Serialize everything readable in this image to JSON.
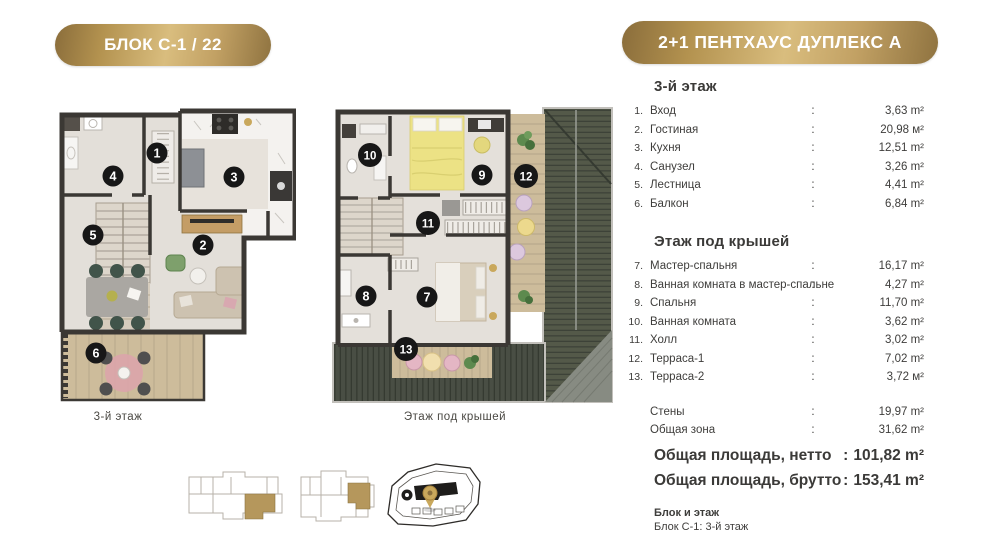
{
  "header": {
    "block_badge": "БЛОК С-1 / 22",
    "unit_badge": "2+1 ПЕНТХАУС ДУПЛЕКС А"
  },
  "punct": {
    "colon": ":"
  },
  "floor3": {
    "title": "3-й этаж",
    "plan_caption": "3-й  этаж",
    "items": [
      {
        "num": "1.",
        "label": "Вход",
        "value": "3,63 m²"
      },
      {
        "num": "2.",
        "label": "Гостиная",
        "value": "20,98 м²"
      },
      {
        "num": "3.",
        "label": "Кухня",
        "value": "12,51 m²"
      },
      {
        "num": "4.",
        "label": "Санузел",
        "value": "3,26 m²"
      },
      {
        "num": "5.",
        "label": "Лестница",
        "value": "4,41 m²"
      },
      {
        "num": "6.",
        "label": "Балкон",
        "value": "6,84 m²"
      }
    ]
  },
  "attic": {
    "title": "Этаж под крышей",
    "plan_caption": "Этаж под крышей",
    "items": [
      {
        "num": "7.",
        "label": "Мастер-спальня",
        "value": "16,17 m²"
      },
      {
        "num": "8.",
        "label": "Ванная комната в мастер-спальне",
        "value": "4,27 m²"
      },
      {
        "num": "9.",
        "label": "Спальня",
        "value": "11,70 m²"
      },
      {
        "num": "10.",
        "label": "Ванная комната",
        "value": "3,62 m²"
      },
      {
        "num": "11.",
        "label": "Холл",
        "value": "3,02 m²"
      },
      {
        "num": "12.",
        "label": "Терраса-1",
        "value": "7,02 m²"
      },
      {
        "num": "13.",
        "label": "Терраса-2",
        "value": "3,72 м²"
      }
    ]
  },
  "summary": {
    "rows": [
      {
        "label": "Стены",
        "value": "19,97 m²"
      },
      {
        "label": "Общая зона",
        "value": "31,62 m²"
      }
    ],
    "totals": [
      {
        "label": "Общая площадь, нетто",
        "value": "101,82 m²"
      },
      {
        "label": "Общая площадь, брутто",
        "value": "153,41 m²"
      }
    ]
  },
  "footer": {
    "block_title": "Блок и этаж",
    "block_value": "Блок С-1:  3-й этаж"
  },
  "markers": {
    "floor3": [
      "1",
      "2",
      "3",
      "4",
      "5",
      "6"
    ],
    "attic": [
      "7",
      "8",
      "9",
      "10",
      "11",
      "12",
      "13"
    ]
  },
  "colors": {
    "gold_dark": "#8f7340",
    "gold_light": "#d9bd7e",
    "wall": "#3b3834",
    "floor": "#e3dfd9",
    "deck_wood": "#cdbc9b",
    "roof_dark": "#4a4f45",
    "unit_highlight": "#b5975c"
  }
}
